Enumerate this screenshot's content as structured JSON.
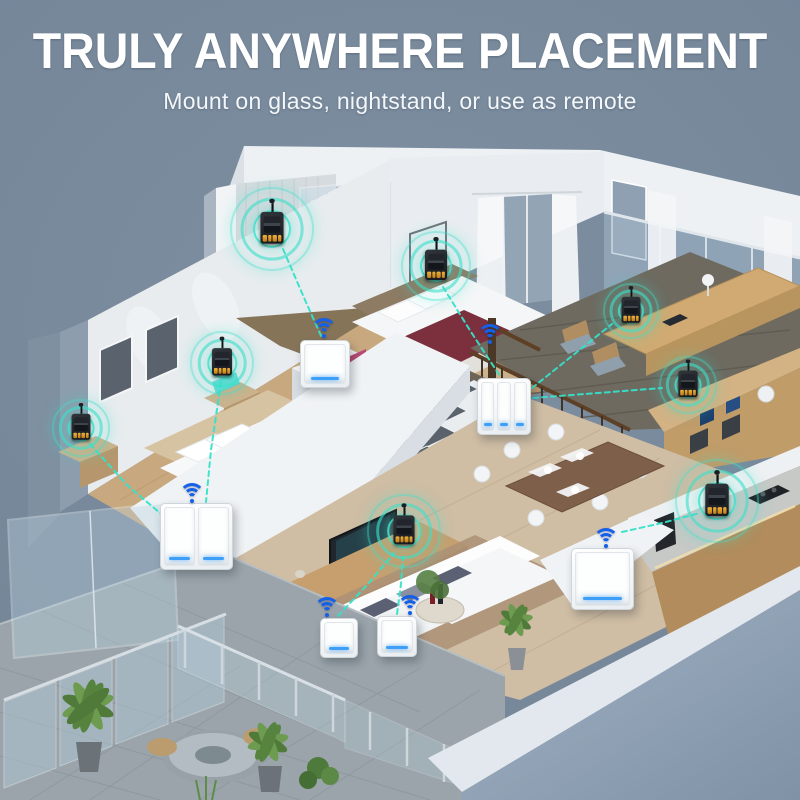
{
  "header": {
    "title": "TRULY ANYWHERE PLACEMENT",
    "subtitle": "Mount on glass, nightstand, or use as remote"
  },
  "colors": {
    "background": "#76879a",
    "accent_teal": "#35e2c9",
    "wifi_blue": "#1660e8",
    "switch_indicator_blue": "#3d9ff7",
    "relay_terminal_orange": "#e0a12e",
    "headline_white": "#ffffff"
  },
  "scene": {
    "relays": [
      {
        "id": "bathroom-wall",
        "x": 272,
        "y": 229,
        "r": 40,
        "s": 1.1
      },
      {
        "id": "bedroom2-nightstand",
        "x": 436,
        "y": 266,
        "r": 33,
        "s": 1.05
      },
      {
        "id": "bedroom1-wall",
        "x": 222,
        "y": 363,
        "r": 30,
        "s": 0.95
      },
      {
        "id": "bedroom1-nightstand",
        "x": 81,
        "y": 428,
        "r": 27,
        "s": 0.9
      },
      {
        "id": "office-desk",
        "x": 631,
        "y": 311,
        "r": 26,
        "s": 0.9
      },
      {
        "id": "office-shelf",
        "x": 688,
        "y": 385,
        "r": 27,
        "s": 0.92
      },
      {
        "id": "kitchen-counter",
        "x": 717,
        "y": 501,
        "r": 40,
        "s": 1.12
      },
      {
        "id": "tv-cabinet",
        "x": 404,
        "y": 531,
        "r": 35,
        "s": 1.0
      }
    ],
    "switches": [
      {
        "id": "bedroom1-2gang",
        "gangs": 2,
        "x": 160,
        "y": 503,
        "w": 73,
        "h": 67
      },
      {
        "id": "stairs-3gang",
        "gangs": 3,
        "x": 477,
        "y": 378,
        "w": 54,
        "h": 57
      },
      {
        "id": "bedroom2-remote",
        "gangs": 1,
        "x": 300,
        "y": 340,
        "w": 50,
        "h": 48
      },
      {
        "id": "dining-1gang",
        "gangs": 1,
        "x": 571,
        "y": 548,
        "w": 63,
        "h": 62
      },
      {
        "id": "living-remote-1",
        "gangs": 1,
        "x": 320,
        "y": 618,
        "w": 38,
        "h": 40
      },
      {
        "id": "living-remote-2",
        "gangs": 1,
        "x": 377,
        "y": 616,
        "w": 40,
        "h": 41
      }
    ],
    "wifi": [
      {
        "id": "bedroom1",
        "x": 192,
        "y": 503
      },
      {
        "id": "bedroom2",
        "x": 324,
        "y": 338
      },
      {
        "id": "stairs",
        "x": 490,
        "y": 344
      },
      {
        "id": "dining",
        "x": 606,
        "y": 548
      },
      {
        "id": "living-1",
        "x": 327,
        "y": 617
      },
      {
        "id": "living-2",
        "x": 410,
        "y": 615
      }
    ],
    "links": [
      {
        "id": "bathroom-to-remote",
        "points": "283,249 305,300 322,338"
      },
      {
        "id": "bedroom2-to-3gang",
        "points": "443,287 471,332 500,376"
      },
      {
        "id": "bedroom1wall-to-2gang",
        "points": "221,382 211,450 206,502"
      },
      {
        "id": "bedroom1night-to-2gang",
        "points": "90,444 128,486 166,518"
      },
      {
        "id": "3gang-to-office-desk",
        "points": "532,388 572,356 612,324"
      },
      {
        "id": "3gang-to-office-shelf",
        "points": "533,398 598,393 662,388"
      },
      {
        "id": "dining-to-kitchen",
        "points": "622,532 662,523 700,513"
      },
      {
        "id": "living1-to-tv",
        "points": "338,616 368,584 394,553"
      },
      {
        "id": "living2-to-tv",
        "points": "397,614 401,584 403,557"
      }
    ]
  }
}
